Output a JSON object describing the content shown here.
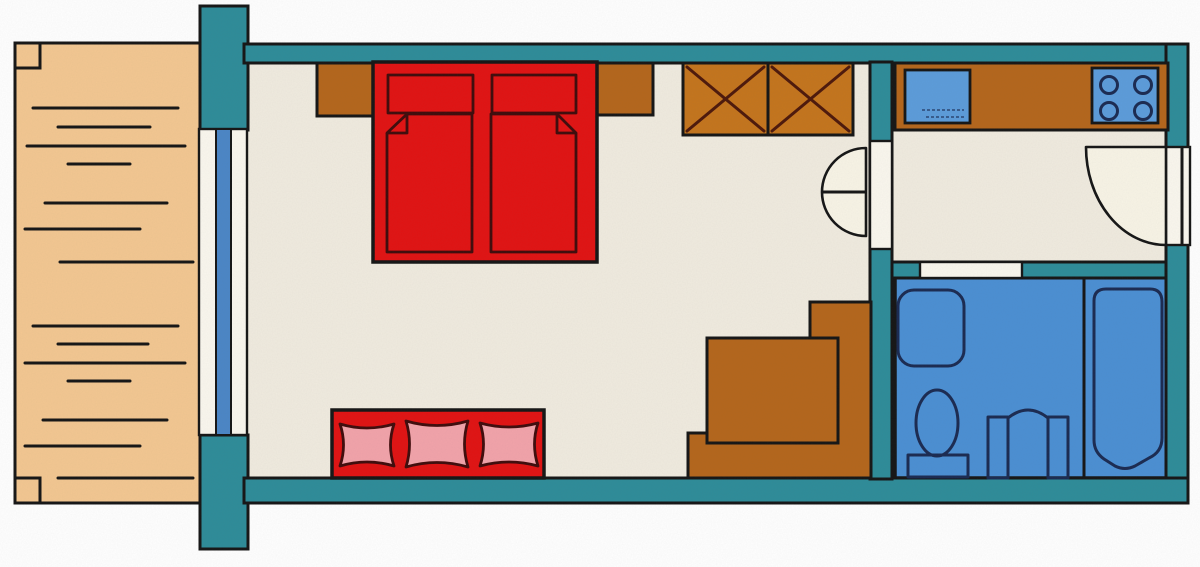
{
  "title": "studio-apartment-floor-plan",
  "colors": {
    "wall": "#2e8c99",
    "outline": "#161616",
    "deck": "#f3c791",
    "floor": "#f0ebdf",
    "ivory": "#f8f4e6",
    "opening": "#faf7ee",
    "bed_red": "#e11313",
    "bed_outline": "#400c0c",
    "cushion_pink": "#f2a3aa",
    "furniture_brown": "#b4661c",
    "wardrobe_brown": "#c4751d",
    "brace": "#4e190b",
    "bath_blue": "#4b8fd3",
    "appliance_blue": "#5c9cda",
    "glass_blue": "#4b86c6",
    "fixture_outline": "#1b2b52"
  },
  "plan": {
    "type": "apartment floor plan, hand-drawn colored style",
    "rooms": [
      {
        "id": "balcony-deck",
        "features": "wood plank deck",
        "planks": 14,
        "corner_posts": 2
      },
      {
        "id": "main-room",
        "furniture": [
          {
            "name": "double-bed",
            "pillows": 2,
            "mattresses": 2,
            "folded_corners": 2
          },
          {
            "name": "bedside-cabinet",
            "count": 2
          },
          {
            "name": "wardrobe",
            "sections": 2,
            "marking": "X-braces"
          },
          {
            "name": "sofa",
            "cushions": 3
          },
          {
            "name": "table",
            "count": 1
          },
          {
            "name": "corner-bench",
            "shape": "L"
          }
        ]
      },
      {
        "id": "kitchen-hallway",
        "furniture": [
          {
            "name": "kitchen-counter"
          },
          {
            "name": "sink",
            "count": 1
          },
          {
            "name": "stove",
            "burners": 4
          }
        ]
      },
      {
        "id": "bathroom",
        "fixtures": [
          {
            "name": "shower-tray"
          },
          {
            "name": "toilet"
          },
          {
            "name": "washbasin"
          },
          {
            "name": "bathtub"
          }
        ]
      }
    ],
    "doors_and_windows": [
      {
        "name": "balcony-window",
        "type": "glazed sliding window"
      },
      {
        "name": "main-room-door",
        "swing": "half-circle arc"
      },
      {
        "name": "entrance-door",
        "swing": "quarter-circle arc",
        "location": "right wall"
      },
      {
        "name": "bathroom-opening",
        "type": "plain opening"
      }
    ]
  }
}
